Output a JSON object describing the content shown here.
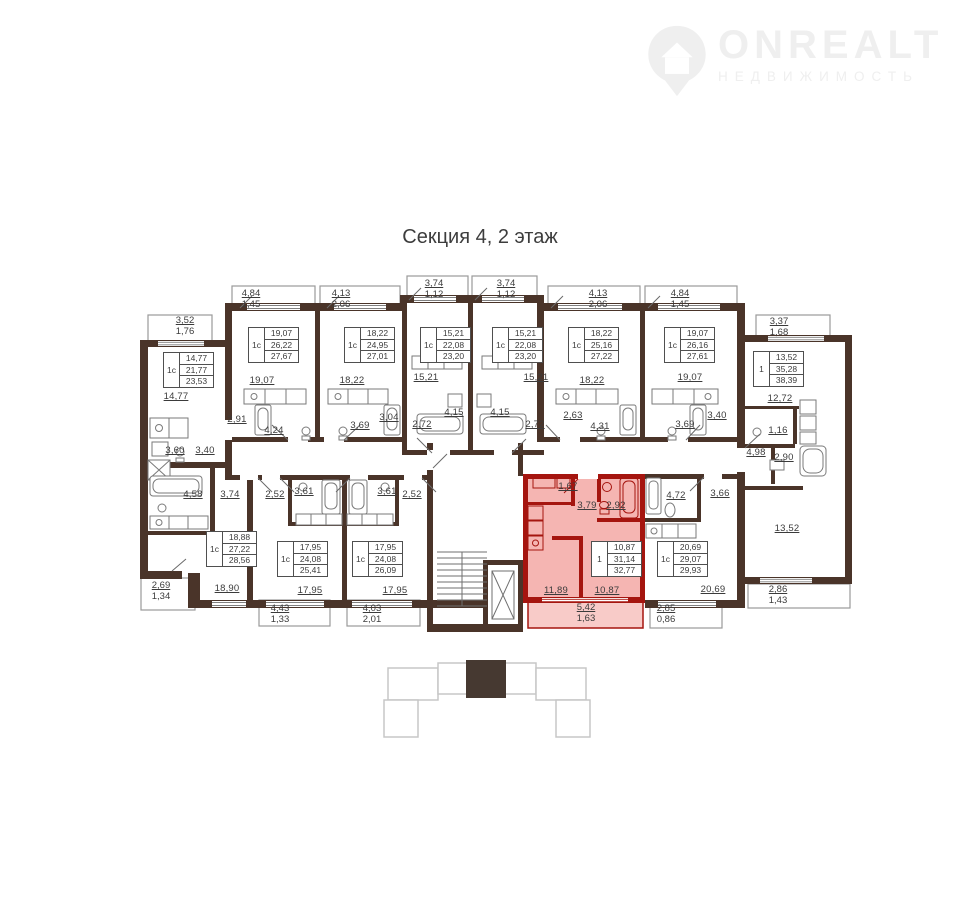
{
  "title": "Секция 4, 2 этаж",
  "logo": {
    "brand": "ONREALT",
    "tagline": "НЕДВИЖИМОСТЬ"
  },
  "colors": {
    "wall": "#4a3429",
    "highlight_wall": "#a5150f",
    "highlight_fill": "#f5b5b2",
    "highlight_balcony": "#f8cbc8",
    "text": "#3b3b3b",
    "thin_line": "#7a7a7a",
    "logo": "#efefef",
    "keyplan_line": "#c7c7c7",
    "keyplan_fill": "#463931"
  },
  "plan": {
    "apartments": [
      {
        "x": 163,
        "y": 352,
        "type": "1с",
        "v1": "14,77",
        "v2": "21,77",
        "v3": "23,53"
      },
      {
        "x": 248,
        "y": 327,
        "type": "1с",
        "v1": "19,07",
        "v2": "26,22",
        "v3": "27,67"
      },
      {
        "x": 344,
        "y": 327,
        "type": "1с",
        "v1": "18,22",
        "v2": "24,95",
        "v3": "27,01"
      },
      {
        "x": 420,
        "y": 327,
        "type": "1с",
        "v1": "15,21",
        "v2": "22,08",
        "v3": "23,20"
      },
      {
        "x": 492,
        "y": 327,
        "type": "1с",
        "v1": "15,21",
        "v2": "22,08",
        "v3": "23,20"
      },
      {
        "x": 568,
        "y": 327,
        "type": "1с",
        "v1": "18,22",
        "v2": "25,16",
        "v3": "27,22"
      },
      {
        "x": 664,
        "y": 327,
        "type": "1с",
        "v1": "19,07",
        "v2": "26,16",
        "v3": "27,61"
      },
      {
        "x": 753,
        "y": 351,
        "type": "1",
        "v1": "13,52",
        "v2": "35,28",
        "v3": "38,39"
      },
      {
        "x": 206,
        "y": 531,
        "type": "1с",
        "v1": "18,88",
        "v2": "27,22",
        "v3": "28,56"
      },
      {
        "x": 277,
        "y": 541,
        "type": "1с",
        "v1": "17,95",
        "v2": "24,08",
        "v3": "25,41"
      },
      {
        "x": 352,
        "y": 541,
        "type": "1с",
        "v1": "17,95",
        "v2": "24,08",
        "v3": "26,09"
      },
      {
        "x": 591,
        "y": 541,
        "type": "1",
        "v1": "10,87",
        "v2": "31,14",
        "v3": "32,77"
      },
      {
        "x": 657,
        "y": 541,
        "type": "1с",
        "v1": "20,69",
        "v2": "29,07",
        "v3": "29,93"
      }
    ],
    "room_labels": [
      {
        "t": "14,77",
        "x": 176,
        "y": 397
      },
      {
        "t": "19,07",
        "x": 262,
        "y": 381
      },
      {
        "t": "18,22",
        "x": 352,
        "y": 381
      },
      {
        "t": "15,21",
        "x": 426,
        "y": 378
      },
      {
        "t": "15,21",
        "x": 536,
        "y": 378
      },
      {
        "t": "18,22",
        "x": 592,
        "y": 381
      },
      {
        "t": "19,07",
        "x": 690,
        "y": 378
      },
      {
        "t": "12,72",
        "x": 780,
        "y": 399
      },
      {
        "t": "2,91",
        "x": 237,
        "y": 420
      },
      {
        "t": "4,24",
        "x": 274,
        "y": 431
      },
      {
        "t": "3,69",
        "x": 360,
        "y": 426
      },
      {
        "t": "3,04",
        "x": 389,
        "y": 418
      },
      {
        "t": "2,72",
        "x": 422,
        "y": 425
      },
      {
        "t": "4,15",
        "x": 454,
        "y": 413
      },
      {
        "t": "4,15",
        "x": 500,
        "y": 413
      },
      {
        "t": "2,72",
        "x": 535,
        "y": 425
      },
      {
        "t": "2,63",
        "x": 573,
        "y": 416
      },
      {
        "t": "4,31",
        "x": 600,
        "y": 427
      },
      {
        "t": "3,69",
        "x": 685,
        "y": 425
      },
      {
        "t": "3,40",
        "x": 717,
        "y": 416
      },
      {
        "t": "3,60",
        "x": 175,
        "y": 451
      },
      {
        "t": "3,40",
        "x": 205,
        "y": 451
      },
      {
        "t": "1,16",
        "x": 778,
        "y": 431
      },
      {
        "t": "4,98",
        "x": 756,
        "y": 453
      },
      {
        "t": "2,90",
        "x": 784,
        "y": 458
      },
      {
        "t": "13,52",
        "x": 787,
        "y": 529
      },
      {
        "t": "4,58",
        "x": 193,
        "y": 495
      },
      {
        "t": "3,74",
        "x": 230,
        "y": 495
      },
      {
        "t": "2,52",
        "x": 275,
        "y": 495
      },
      {
        "t": "3,61",
        "x": 304,
        "y": 492
      },
      {
        "t": "3,61",
        "x": 387,
        "y": 492
      },
      {
        "t": "2,52",
        "x": 412,
        "y": 495
      },
      {
        "t": "1,67",
        "x": 568,
        "y": 487
      },
      {
        "t": "3,79",
        "x": 587,
        "y": 506
      },
      {
        "t": "2,92",
        "x": 616,
        "y": 506
      },
      {
        "t": "4,72",
        "x": 676,
        "y": 496
      },
      {
        "t": "3,66",
        "x": 720,
        "y": 494
      },
      {
        "t": "18,90",
        "x": 227,
        "y": 589
      },
      {
        "t": "17,95",
        "x": 310,
        "y": 591
      },
      {
        "t": "17,95",
        "x": 395,
        "y": 591
      },
      {
        "t": "11,89",
        "x": 556,
        "y": 591
      },
      {
        "t": "10,87",
        "x": 607,
        "y": 591
      },
      {
        "t": "20,69",
        "x": 713,
        "y": 590
      }
    ],
    "dim_labels": [
      {
        "a": "4,84",
        "b": "1,45",
        "x": 251,
        "y": 289
      },
      {
        "a": "4,13",
        "b": "2,06",
        "x": 341,
        "y": 289
      },
      {
        "a": "3,74",
        "b": "1,12",
        "x": 434,
        "y": 279
      },
      {
        "a": "3,74",
        "b": "1,12",
        "x": 506,
        "y": 279
      },
      {
        "a": "4,13",
        "b": "2,06",
        "x": 598,
        "y": 289
      },
      {
        "a": "4,84",
        "b": "1,45",
        "x": 680,
        "y": 289
      },
      {
        "a": "3,52",
        "b": "1,76",
        "x": 185,
        "y": 316
      },
      {
        "a": "3,37",
        "b": "1,68",
        "x": 779,
        "y": 317
      },
      {
        "a": "2,69",
        "b": "1,34",
        "x": 161,
        "y": 581
      },
      {
        "a": "4,43",
        "b": "1,33",
        "x": 280,
        "y": 604
      },
      {
        "a": "4,03",
        "b": "2,01",
        "x": 372,
        "y": 604
      },
      {
        "a": "5,42",
        "b": "1,63",
        "x": 586,
        "y": 603
      },
      {
        "a": "2,85",
        "b": "0,86",
        "x": 666,
        "y": 604
      },
      {
        "a": "2,86",
        "b": "1,43",
        "x": 778,
        "y": 585
      }
    ]
  }
}
